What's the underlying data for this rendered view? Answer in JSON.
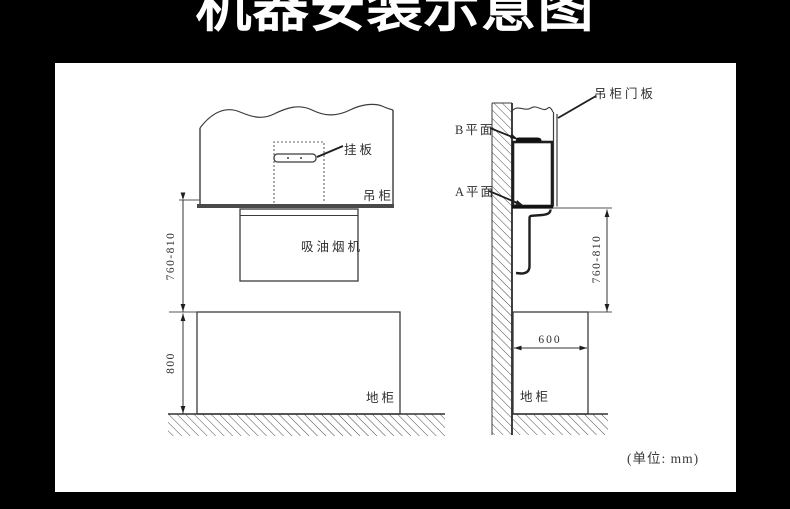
{
  "title": "机器安装示意图",
  "unit_note": "(单位: mm)",
  "front_view": {
    "labels": {
      "hanging_plate": "挂板",
      "wall_cabinet": "吊柜",
      "range_hood": "吸油烟机",
      "floor_cabinet": "地柜"
    },
    "dimensions": {
      "hood_to_counter": "760-810",
      "counter_height": "800"
    }
  },
  "side_view": {
    "labels": {
      "cabinet_door_panel": "吊柜门板",
      "plane_b": "B平面",
      "plane_a": "A平面",
      "floor_cabinet": "地柜"
    },
    "dimensions": {
      "hood_to_counter": "760-810",
      "cabinet_depth": "600"
    }
  },
  "colors": {
    "background": "#000000",
    "panel": "#ffffff",
    "line_dark": "#1e1e1e",
    "line": "#3c3c3c"
  }
}
